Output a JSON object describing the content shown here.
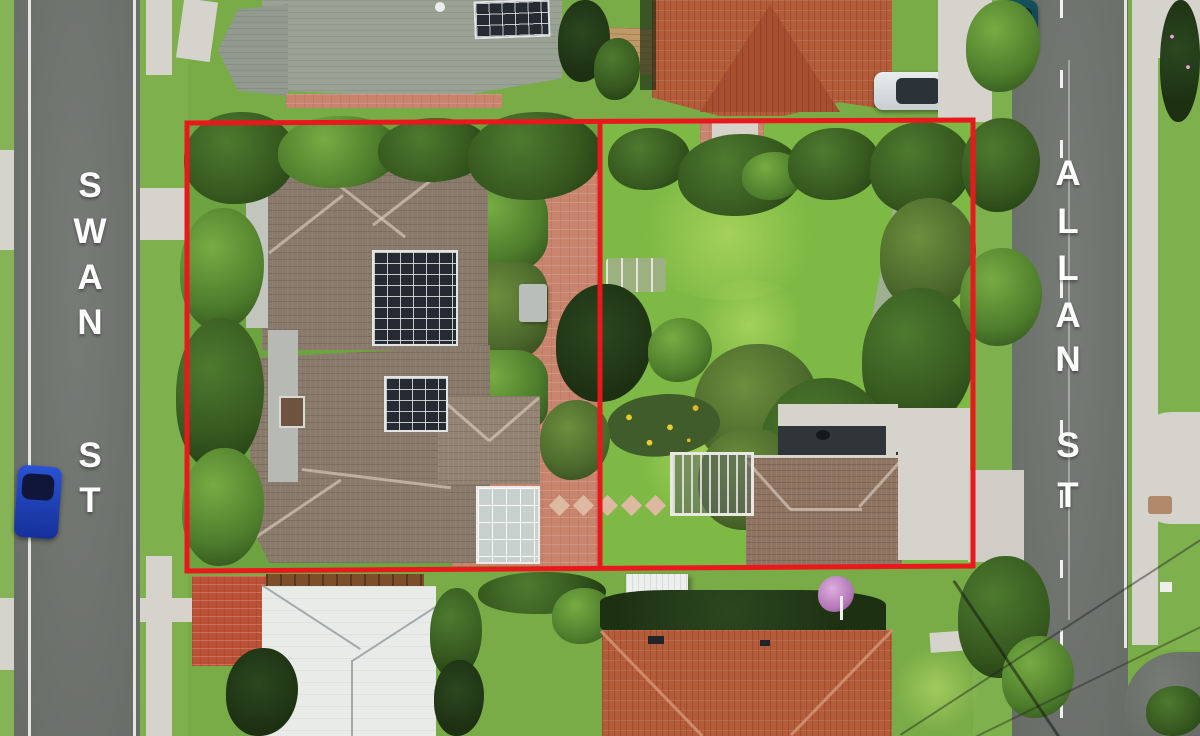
{
  "scene": {
    "description": "Aerial drone photo of two adjoining residential parcels outlined in red, between Swan St and Allan St",
    "boundary_color": "#ea171c",
    "parcel_count": 2
  },
  "streets": {
    "left": {
      "name": "SWAN ST",
      "letters": [
        "S",
        "W",
        "A",
        "N",
        "S",
        "T"
      ]
    },
    "right": {
      "name": "ALLAN ST",
      "letters": [
        "A",
        "L",
        "L",
        "A",
        "N",
        "S",
        "T"
      ]
    }
  },
  "colors": {
    "road": "#70746f",
    "grass": "#79ab47",
    "main_roof": "#897a6b",
    "terracotta_roof": "#b45c39",
    "light_roof": "#e9ebe9",
    "green_gray_roof": "#99a295",
    "brick_paving": "#c8846d"
  },
  "vehicles": [
    {
      "name": "blue-car",
      "color": "#1d3fae"
    },
    {
      "name": "silver-car",
      "color": "#dde1e4"
    },
    {
      "name": "teal-car",
      "color": "#16505a"
    }
  ]
}
